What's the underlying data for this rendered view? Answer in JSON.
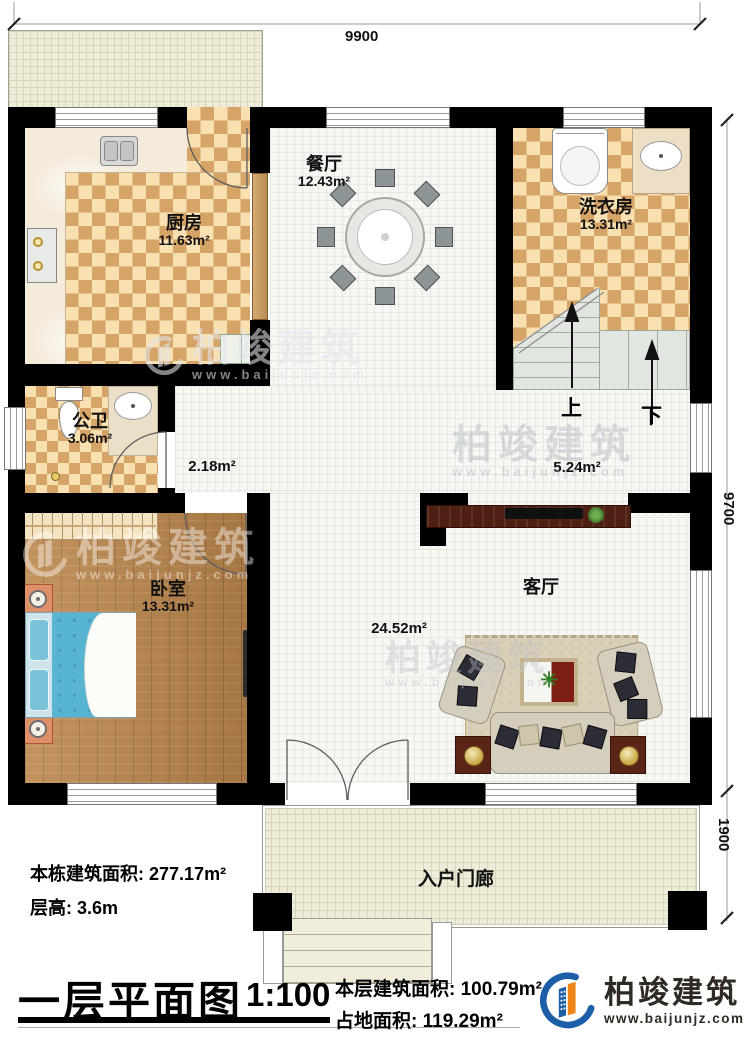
{
  "plan": {
    "dims": {
      "top": "9900",
      "right": "9700",
      "right_lower": "1900"
    },
    "rooms": {
      "kitchen": {
        "name": "厨房",
        "area": "11.63m²"
      },
      "dining": {
        "name": "餐厅",
        "area": "12.43m²"
      },
      "laundry": {
        "name": "洗衣房",
        "area": "13.31m²"
      },
      "bathroom": {
        "name": "公卫",
        "area": "3.06m²"
      },
      "bedroom": {
        "name": "卧室",
        "area": "13.31m²"
      },
      "living": {
        "name": "客厅",
        "area": "24.52m²"
      },
      "porch": {
        "name": "入户门廊"
      }
    },
    "areas": {
      "corridor": "2.18m²",
      "stair_hall": "5.24m²"
    },
    "stairs": {
      "up": "上",
      "down": "下"
    }
  },
  "info": {
    "building_area_label": "本栋建筑面积:",
    "building_area": "277.17m²",
    "floor_height_label": "层高:",
    "floor_height": "3.6m"
  },
  "titleblock": {
    "title": "一层平面图",
    "scale": "1:100",
    "floor_area_label": "本层建筑面积:",
    "floor_area": "100.79m²",
    "footprint_label": "占地面积:",
    "footprint": "119.29m²"
  },
  "brand": {
    "name": "柏竣建筑",
    "website": "www.baijunjz.com",
    "blue": "#1c5fa8",
    "orange": "#ef8519"
  },
  "watermark": {
    "name": "柏竣建筑",
    "website": "www.baijunjz.com"
  }
}
